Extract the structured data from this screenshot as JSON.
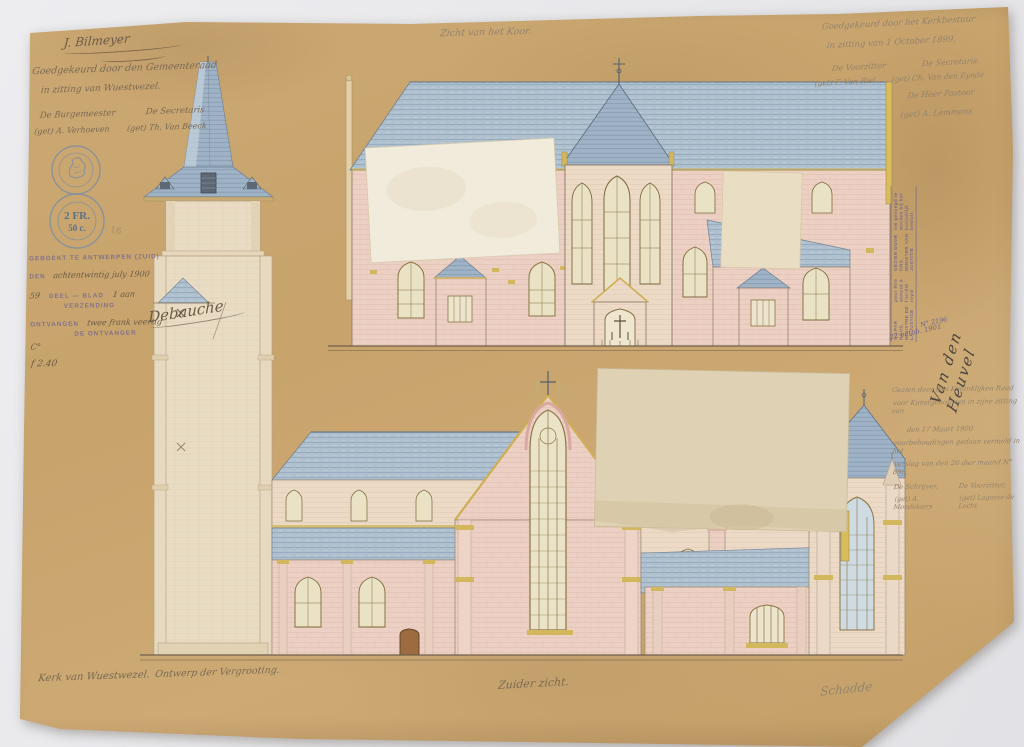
{
  "titles": {
    "top_center": "Zicht van het Koor.",
    "bottom_center": "Zuider zicht.",
    "bottom_left_line1": "Kerk van Wuestwezel.",
    "bottom_left_line2": "Ontwerp der Vergrooting.",
    "bottom_right_signature": "Schadde"
  },
  "architect_signature": "J. Bilmeyer",
  "municipal_approval": {
    "line1": "Goedgekeurd door den Gemeenteraad",
    "line2": "in zitting van Wuestwezel.",
    "left_title": "De Burgemeester",
    "right_title": "De Secretaris",
    "left_sig": "(get) A. Verhoeven",
    "right_sig": "(get) Th. Van Beeck"
  },
  "church_board_approval": {
    "line1": "Goedgekeurd door het Kerkbestuur",
    "line2": "in zitting van 1 October 1899.",
    "left_title": "De Voorzitter",
    "right_title": "De Secretaris",
    "left_sig": "(get) F. Van Riel",
    "right_sig": "(get) Ch. Van den Eynde",
    "pastor_line": "De Heer Pastoor",
    "pastor_sig": "(get) A. Lemmens"
  },
  "royal_council_note": {
    "line1": "Gezien door den Koninklijken Raad",
    "line2": "voor Kunstgebouwen in zijne zitting van",
    "line3": "den 17 Maart 1900",
    "line4": "voorbehoudingen gedaan vermeld in het",
    "line5": "verslag van den 26 dier maand N° 898.",
    "left_title": "De Schrijver,",
    "right_title": "De Voorzitter,",
    "left_sig": "(get) A. Mondelaers",
    "right_sig": "(get) Lagasse de Locht"
  },
  "registry_stamp": {
    "line1": "GEBOEKT TE ANTWERPEN (ZUID)",
    "line2_label": "DEN",
    "line2_value": "achtentwintig july 1900",
    "line3_value": "59",
    "line3_label": "DEEL — BLAD",
    "line3_extra": "1 aan",
    "line4_label": "VERZENDING",
    "line5_label": "ONTVANGEN",
    "line5_value": "twee frank veertig",
    "line6_label": "DE ONTVANGER",
    "extra_left": "C°",
    "amount": "f 2.40",
    "signature": "Debauche"
  },
  "minister_stamp": {
    "fr_line1": "VU PAR NOUS, MINISTRE DE LA JUSTICE",
    "fr_line2": "pour être annexé à l'arrêté royal",
    "nl_line1": "GEZIEN DOOR ONS, MINISTER VAN JUSTITIE",
    "nl_line2": "om gevoegd te worden bij het koninklijk besluit",
    "date_hand": "22 octob. 1901",
    "ref_hand": "N° 2196",
    "signature": "Van den Heuvel"
  },
  "revenue_stamps": {
    "top_ring": "GOUVERNEMENT PROVINCIAL ANVERS",
    "bottom_ring": "TIMBRE DE DIMENSION",
    "bottom_value_line1": "2 FR.",
    "bottom_value_line2": "50 c."
  },
  "pencil_mark": "16",
  "colors": {
    "paper": "#c8a36c",
    "roof_blue": "#aebfce",
    "wall_pink": "#ecd0c3",
    "accent_yellow": "#d3b75c",
    "stamp_purple": "#68558e",
    "ink": "#7a6a54"
  }
}
